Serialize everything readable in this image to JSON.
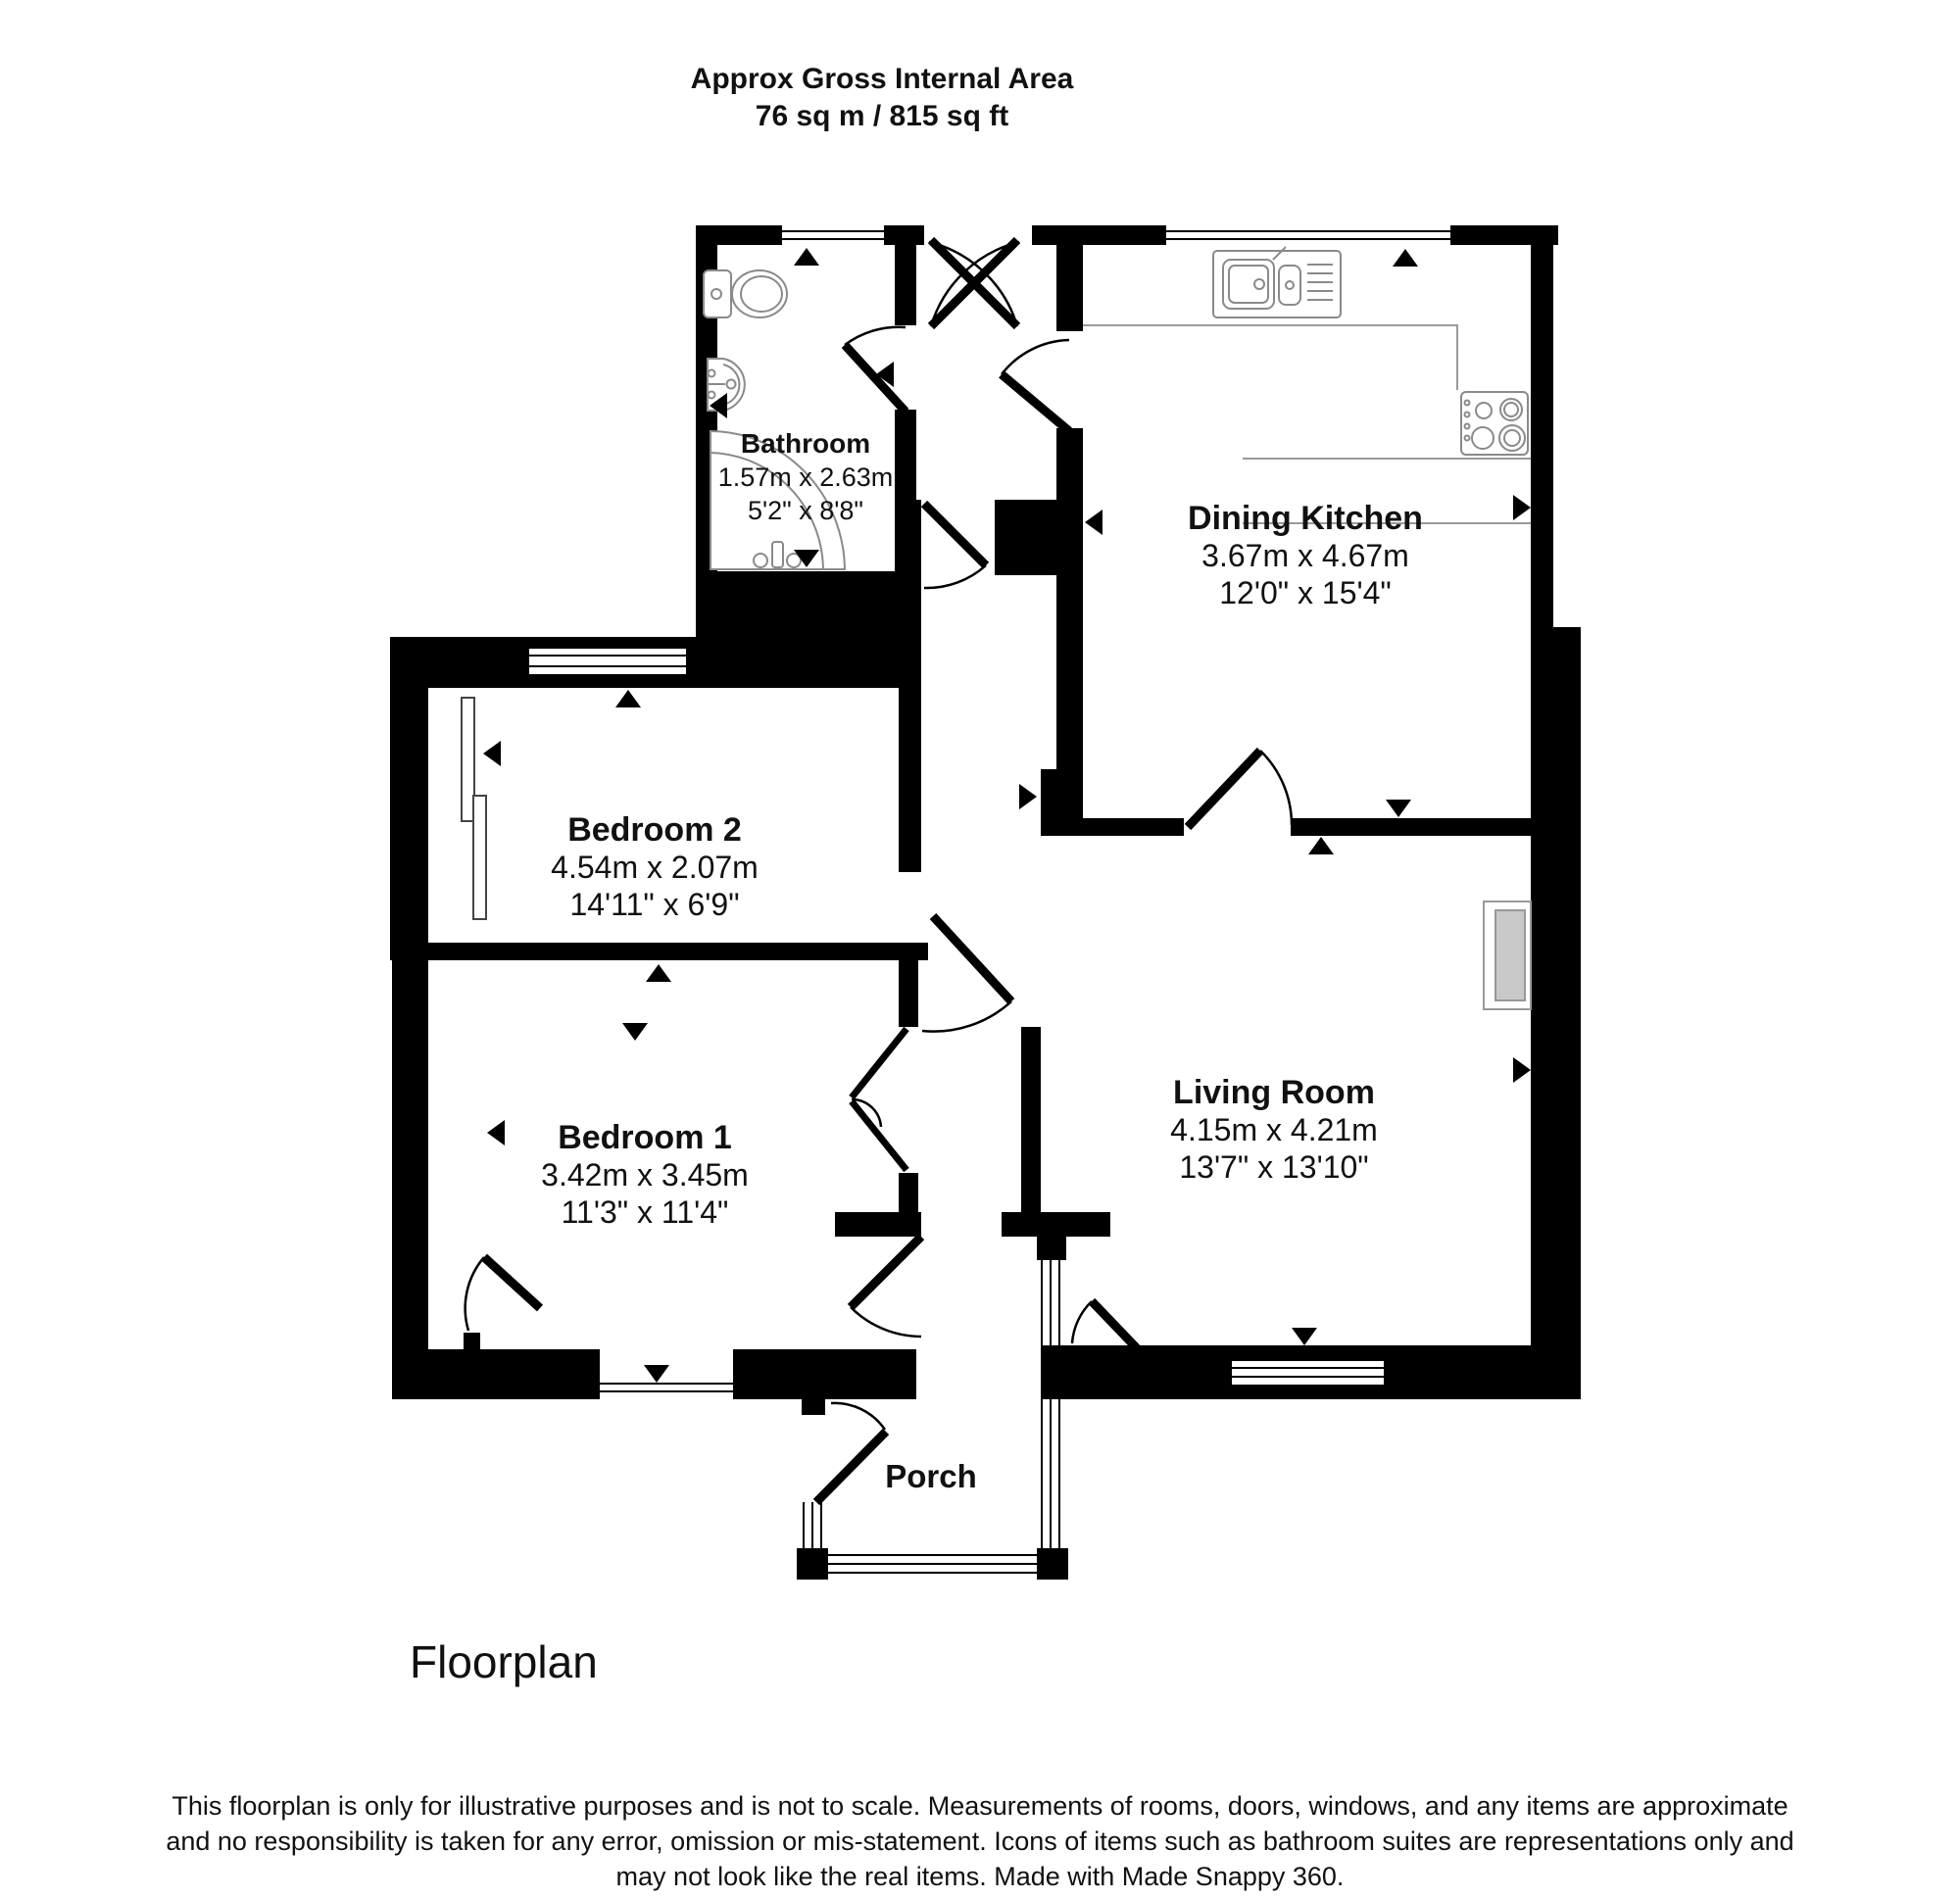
{
  "header": {
    "title_line1": "Approx Gross Internal Area",
    "title_line2": "76 sq m / 815 sq ft"
  },
  "rooms": {
    "bathroom": {
      "name": "Bathroom",
      "metric": "1.57m x 2.63m",
      "imperial": "5'2\" x 8'8\""
    },
    "dining_kitchen": {
      "name": "Dining Kitchen",
      "metric": "3.67m x 4.67m",
      "imperial": "12'0\" x 15'4\""
    },
    "bedroom2": {
      "name": "Bedroom 2",
      "metric": "4.54m x 2.07m",
      "imperial": "14'11\" x 6'9\""
    },
    "bedroom1": {
      "name": "Bedroom 1",
      "metric": "3.42m x 3.45m",
      "imperial": "11'3\" x 11'4\""
    },
    "living_room": {
      "name": "Living Room",
      "metric": "4.15m x 4.21m",
      "imperial": "13'7\" x 13'10\""
    },
    "porch": {
      "name": "Porch"
    }
  },
  "fixtures": [
    "toilet",
    "basin",
    "corner-bath",
    "kitchen-sink",
    "hob",
    "fireplace"
  ],
  "arrows": [
    {
      "room": "bathroom",
      "dir": "up"
    },
    {
      "room": "bathroom",
      "dir": "left"
    },
    {
      "room": "bathroom",
      "dir": "down"
    },
    {
      "room": "hall",
      "dir": "left"
    },
    {
      "room": "dining_kitchen",
      "dir": "up"
    },
    {
      "room": "dining_kitchen",
      "dir": "left"
    },
    {
      "room": "dining_kitchen",
      "dir": "right"
    },
    {
      "room": "dining_kitchen",
      "dir": "down"
    },
    {
      "room": "living_room",
      "dir": "up"
    },
    {
      "room": "living_room",
      "dir": "left"
    },
    {
      "room": "living_room",
      "dir": "right"
    },
    {
      "room": "living_room",
      "dir": "down"
    },
    {
      "room": "bedroom2",
      "dir": "up"
    },
    {
      "room": "bedroom2",
      "dir": "left"
    },
    {
      "room": "landing",
      "dir": "right"
    },
    {
      "room": "bedroom2",
      "dir": "down"
    },
    {
      "room": "bedroom1",
      "dir": "up"
    },
    {
      "room": "bedroom1",
      "dir": "left"
    },
    {
      "room": "bedroom1",
      "dir": "down"
    }
  ],
  "colors": {
    "wall": "#000000",
    "background": "#ffffff",
    "fixture_outline": "#8a8a8a",
    "fireplace_fill": "#c9c9c9"
  },
  "footer": {
    "caption": "Floorplan",
    "disclaimer_line1": "This floorplan is only for illustrative purposes and is not to scale. Measurements of rooms, doors, windows, and any items are approximate",
    "disclaimer_line2": "and no responsibility is taken for any error, omission or mis-statement. Icons of items such as bathroom suites are representations only and",
    "disclaimer_line3": "may not look like the real items. Made with Made Snappy 360."
  }
}
